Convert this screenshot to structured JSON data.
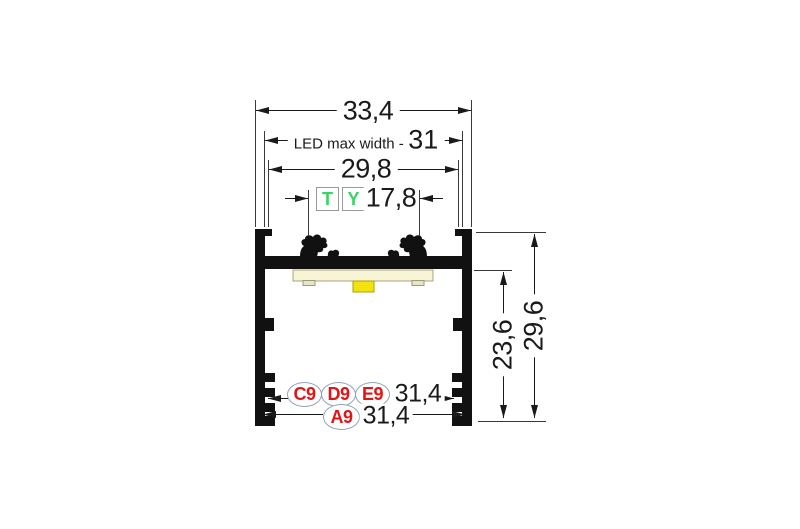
{
  "diagram": {
    "top_dimensions": {
      "overall_width": "33,4",
      "led_max_width_label": "LED max width -",
      "led_max_width_value": "31",
      "opening_width": "29,8",
      "clip_spacing": "17,8"
    },
    "cover_links": {
      "t": "T",
      "y": "Y"
    },
    "side_dimensions": {
      "cavity_depth": "23,6",
      "overall_height": "29,6"
    },
    "bottom_rows": {
      "row1": {
        "labels": [
          "C9",
          "D9",
          "E9"
        ],
        "width": "31,4"
      },
      "row2": {
        "label": "A9",
        "width": "31,4"
      }
    },
    "colors": {
      "profile_black": "#111111",
      "pcb_cream": "#f8f5d6",
      "led_yellow": "#f2e30e",
      "cover_letter_green": "#3ed168",
      "accessory_red": "#e01616",
      "oval_outline_blue": "#93a1b8"
    }
  }
}
